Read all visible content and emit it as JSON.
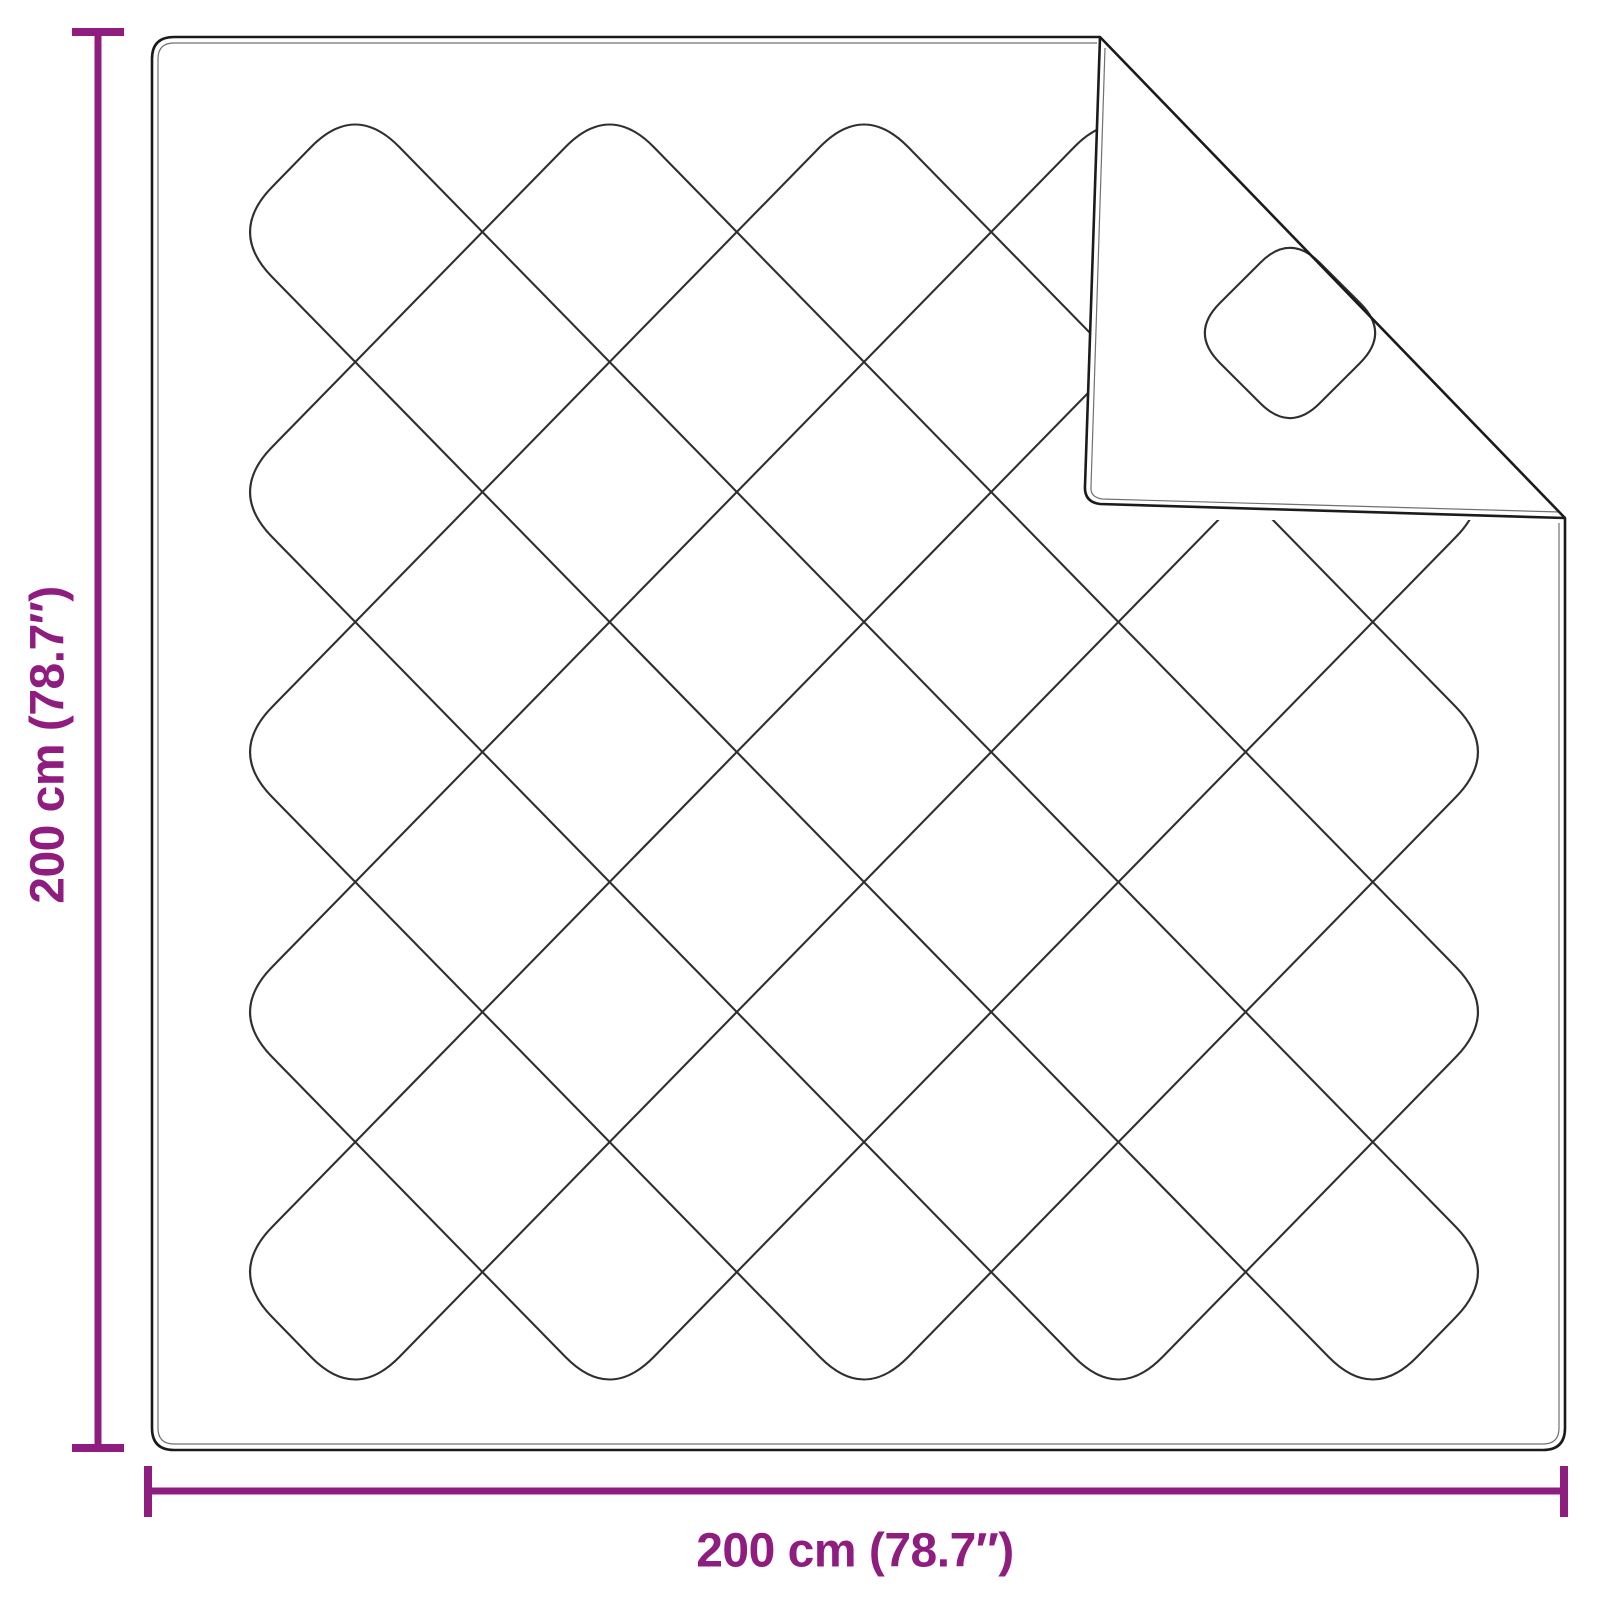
{
  "title": "Blanket dimension diagram",
  "colors": {
    "background": "#ffffff",
    "accent": "#8F1C7F",
    "outline": "#1b1b1b",
    "pattern_line": "#2f2f2f",
    "inner_edge": "#707070"
  },
  "dimensions": {
    "left": {
      "label": "200 cm (78.7″)",
      "value_cm": 200,
      "value_in": 78.7
    },
    "bottom": {
      "label": "200 cm (78.7″)",
      "value_cm": 200,
      "value_in": 78.7
    }
  },
  "figure": {
    "kind": "quilted-blanket-top-view-with-folded-corner",
    "blanket": {
      "x": 152,
      "y": 37,
      "width": 1413,
      "height": 1413,
      "corner_radius": 22
    },
    "quilt": {
      "x0": 228,
      "y0": 102,
      "x1": 1500,
      "y1": 1402,
      "half_pitch_x": 127.2,
      "half_pitch_y": 130,
      "rings": [
        1,
        3,
        5,
        7,
        9
      ],
      "corner_radius": 63
    },
    "fold": {
      "crease_from": [
        1100,
        37
      ],
      "crease_to": [
        1565,
        518
      ],
      "flap_corner": [
        1084,
        502
      ],
      "diamond": {
        "points": [
          [
            1290,
            233
          ],
          [
            1390,
            333
          ],
          [
            1290,
            433
          ],
          [
            1190,
            333
          ]
        ],
        "corner_radius": 42
      }
    }
  }
}
